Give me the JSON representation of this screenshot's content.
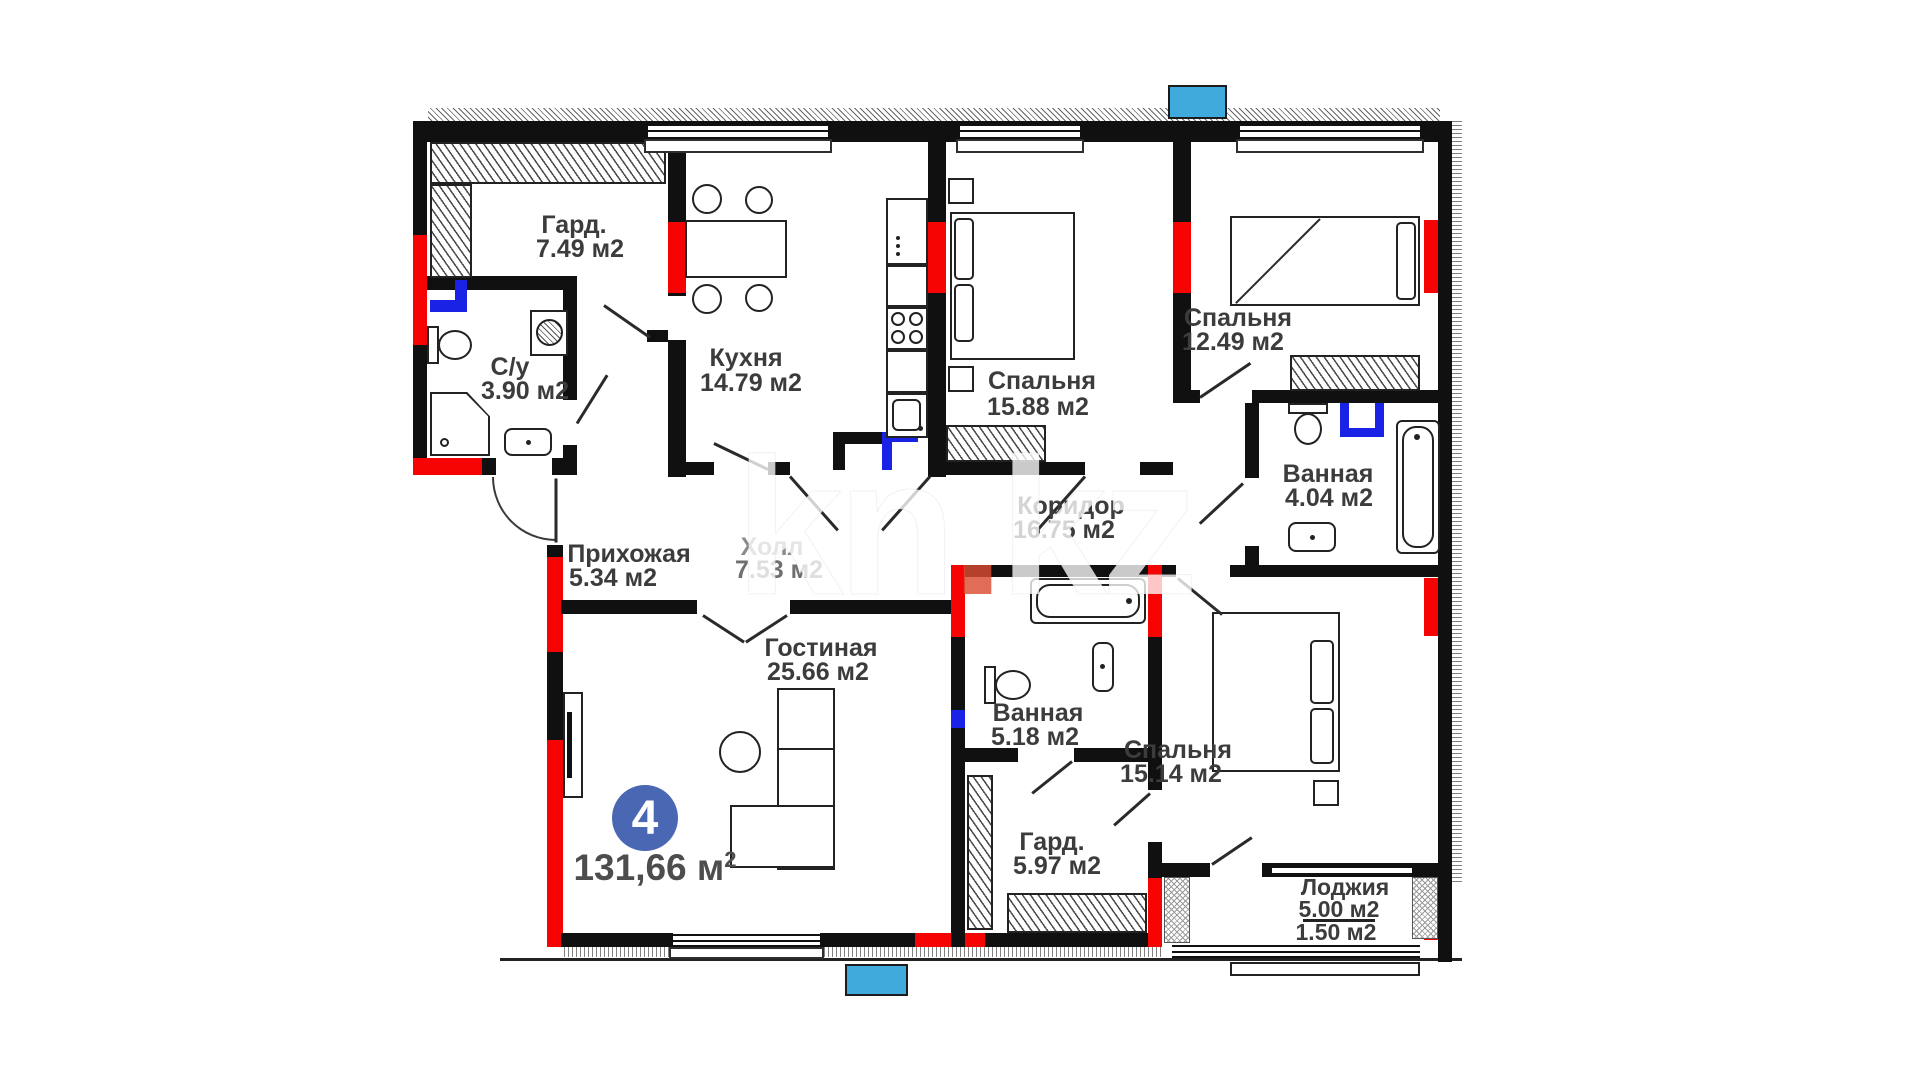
{
  "plan": {
    "type": "apartment-floor-plan",
    "badge": {
      "number": "4",
      "total_area": "131,66 м",
      "total_area_sup": "2"
    },
    "watermark": {
      "part1": "kn",
      "dot": ".",
      "part2": "kz"
    },
    "colors": {
      "wall": "#101010",
      "accent_red": "#f60303",
      "pipe_blue": "#1a22e6",
      "balcony_blue": "#41aadd",
      "badge_blue": "#4a67b4",
      "label_text": "#3c3c3c"
    },
    "rooms": [
      {
        "name": "Гард.",
        "area": "7.49 м2"
      },
      {
        "name": "С/у",
        "area": "3.90 м2"
      },
      {
        "name": "Кухня",
        "area": "14.79 м2"
      },
      {
        "name": "Спальня",
        "area": "15.88 м2"
      },
      {
        "name": "Спальня",
        "area": "12.49 м2"
      },
      {
        "name": "Ванная",
        "area": "4.04 м2"
      },
      {
        "name": "Коридор",
        "area": "16.75 м2"
      },
      {
        "name": "Холл",
        "area": "7.53 м2"
      },
      {
        "name": "Прихожая",
        "area": "5.34 м2"
      },
      {
        "name": "Гостиная",
        "area": "25.66 м2"
      },
      {
        "name": "Ванная",
        "area": "5.18 м2"
      },
      {
        "name": "Гард.",
        "area": "5.97 м2"
      },
      {
        "name": "Спальня",
        "area": "15.14 м2"
      },
      {
        "name": "Лоджия",
        "area": "5.00 м2",
        "area2": "1.50 м2"
      }
    ]
  }
}
